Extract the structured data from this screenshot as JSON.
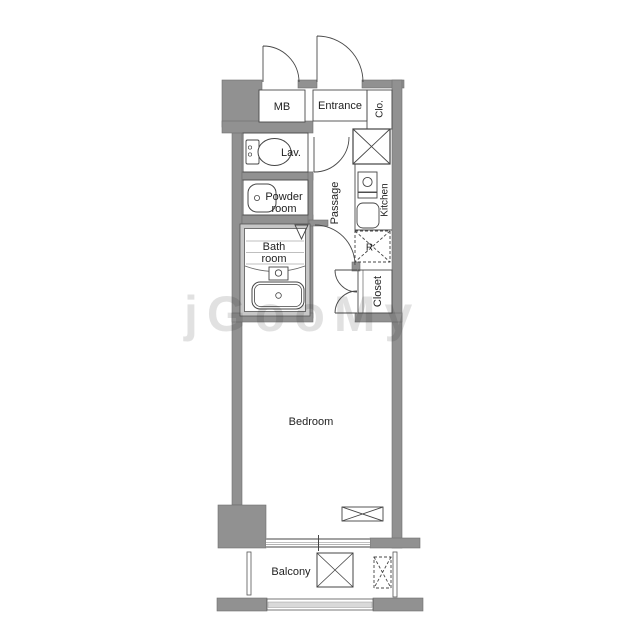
{
  "plan_title": "Studio apartment floor plan",
  "colors": {
    "wall": "#919191",
    "bath_wall": "#c7c7c7",
    "line": "#3a3a3a",
    "rail_fill": "#d9d9d9",
    "watermark": "#8f8f8f"
  },
  "labels": {
    "mb": "MB",
    "entrance": "Entrance",
    "clo": "Clo.",
    "lav": "Lav.",
    "powder_line1": "Powder",
    "powder_line2": "room",
    "passage": "Passage",
    "kitchen": "Kitchen",
    "fridge": "R",
    "bath_line1": "Bath",
    "bath_line2": "room",
    "closet": "Closet",
    "bedroom": "Bedroom",
    "balcony": "Balcony"
  },
  "watermark_text": "jGooMy"
}
